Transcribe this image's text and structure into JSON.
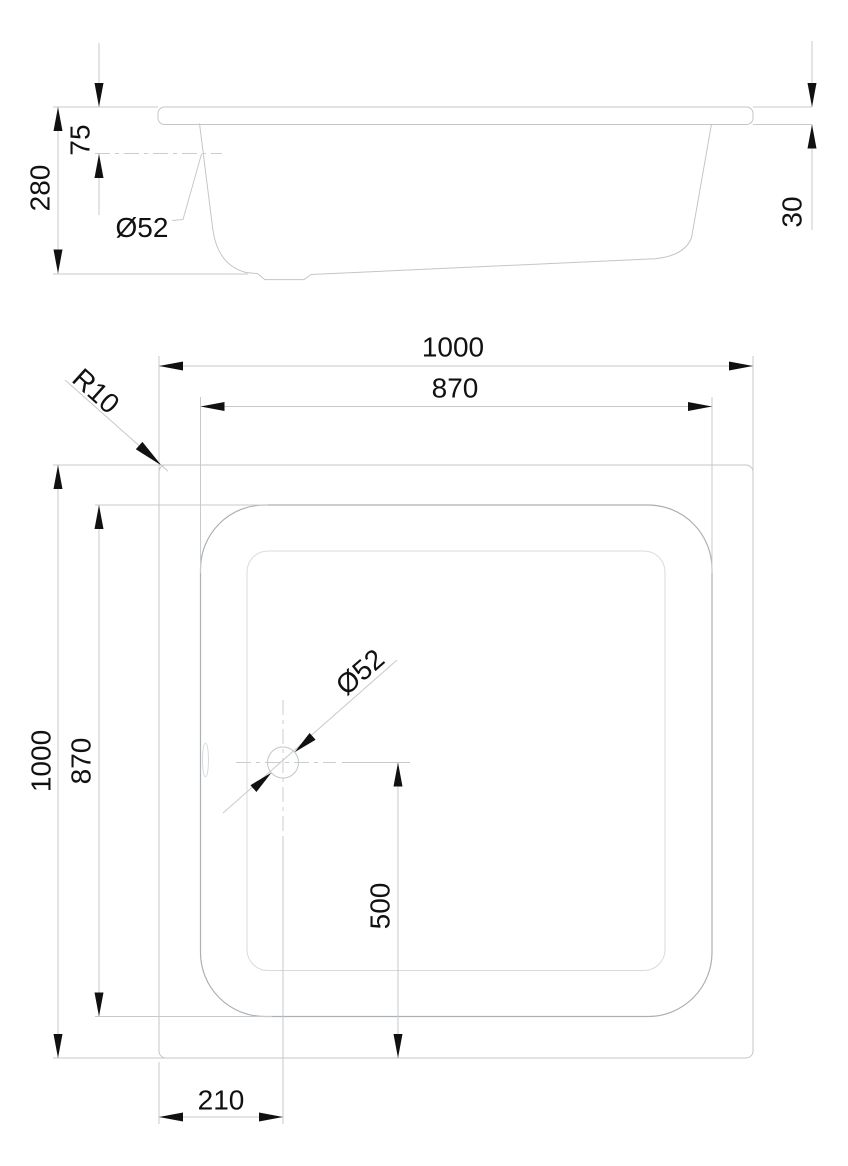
{
  "title": "Shower tray dimensioned drawing",
  "colors": {
    "background": "#ffffff",
    "geometry_line": "#c2c6c9",
    "extension_line": "#c6cacc",
    "ink": "#111111"
  },
  "side_view": {
    "dims": {
      "overall_height": "280",
      "waste_depth": "75",
      "waste_diameter": "Ø52",
      "rim_height": "30"
    }
  },
  "plan_view": {
    "dims": {
      "outer_width": "1000",
      "inner_width": "870",
      "corner_radius": "R10",
      "outer_height": "1000",
      "inner_height": "870",
      "waste_diameter": "Ø52",
      "waste_offset_bottom": "500",
      "waste_offset_left": "210"
    }
  }
}
